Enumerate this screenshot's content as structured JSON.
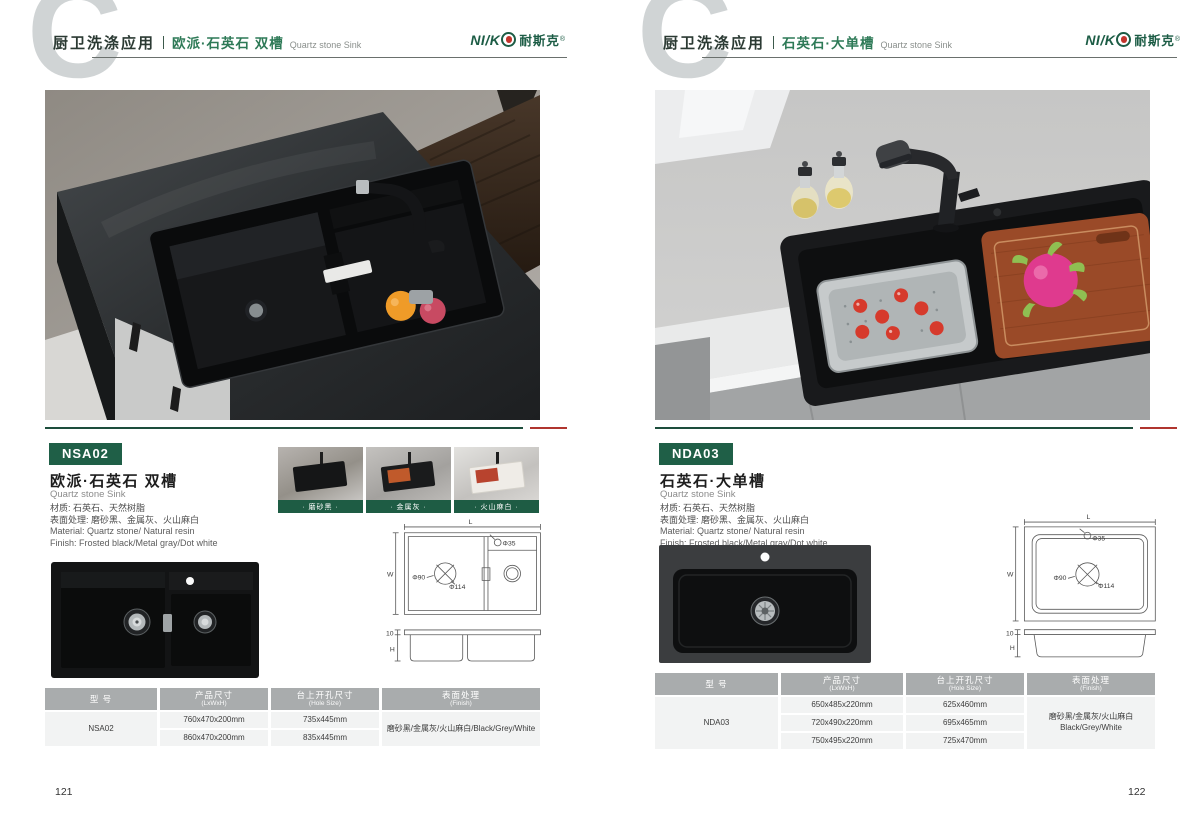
{
  "brand": {
    "logo_left": "NI/K",
    "logo_cn": "耐斯克",
    "trademark": "®"
  },
  "pages": [
    {
      "page_number": "121",
      "header": {
        "monogram": "C",
        "category": "厨卫洗涤应用",
        "product_cn": "欧派·石英石 双槽",
        "product_en": "Quartz stone Sink"
      },
      "product": {
        "code": "NSA02",
        "title_cn": "欧派·石英石 双槽",
        "title_en": "Quartz stone Sink",
        "material_cn": "材质: 石英石、天然树脂",
        "finish_cn": "表面处理: 磨砂黑、金属灰、火山麻白",
        "material_en": "Material: Quartz stone/ Natural resin",
        "finish_en": "Finish: Frosted black/Metal gray/Dot white"
      },
      "swatches": [
        {
          "label": "· 磨砂黑 ·"
        },
        {
          "label": "· 金属灰 ·"
        },
        {
          "label": "· 火山麻白 ·"
        }
      ],
      "drawing": {
        "l": "L",
        "w": "W",
        "h": "H",
        "edge": "10",
        "hole": "Φ35",
        "drain_inner": "Φ90",
        "drain_outer": "Φ114"
      },
      "table": {
        "col1_cn": "型 号",
        "col1_en": "",
        "col2_cn": "产品尺寸",
        "col2_en": "(LxWxH)",
        "col3_cn": "台上开孔尺寸",
        "col3_en": "(Hole Size)",
        "col4_cn": "表面处理",
        "col4_en": "(Finish)",
        "model": "NSA02",
        "rows": [
          {
            "size": "760x470x200mm",
            "hole": "735x445mm"
          },
          {
            "size": "860x470x200mm",
            "hole": "835x445mm"
          }
        ],
        "finish_line1": "磨砂黑/金属灰/火山麻白/Black/Grey/White",
        "finish_line2": ""
      }
    },
    {
      "page_number": "122",
      "header": {
        "monogram": "C",
        "category": "厨卫洗涤应用",
        "product_cn": "石英石·大单槽",
        "product_en": "Quartz stone Sink"
      },
      "product": {
        "code": "NDA03",
        "title_cn": "石英石·大单槽",
        "title_en": "Quartz stone Sink",
        "material_cn": "材质: 石英石、天然树脂",
        "finish_cn": "表面处理: 磨砂黑、金属灰、火山麻白",
        "material_en": "Material: Quartz stone/ Natural resin",
        "finish_en": "Finish: Frosted black/Metal gray/Dot white"
      },
      "drawing": {
        "l": "L",
        "w": "W",
        "h": "H",
        "edge": "10",
        "hole": "Φ35",
        "drain_inner": "Φ90",
        "drain_outer": "Φ114"
      },
      "table": {
        "col1_cn": "型 号",
        "col1_en": "",
        "col2_cn": "产品尺寸",
        "col2_en": "(LxWxH)",
        "col3_cn": "台上开孔尺寸",
        "col3_en": "(Hole Size)",
        "col4_cn": "表面处理",
        "col4_en": "(Finish)",
        "model": "NDA03",
        "rows": [
          {
            "size": "650x485x220mm",
            "hole": "625x460mm"
          },
          {
            "size": "720x490x220mm",
            "hole": "695x465mm"
          },
          {
            "size": "750x495x220mm",
            "hole": "725x470mm"
          }
        ],
        "finish_line1": "磨砂黑/金属灰/火山麻白",
        "finish_line2": "Black/Grey/White"
      }
    }
  ],
  "colors": {
    "brand_green": "#1f5f47",
    "accent_red": "#b0352f",
    "table_header": "#a9acad",
    "table_row": "#f2f3f3"
  }
}
